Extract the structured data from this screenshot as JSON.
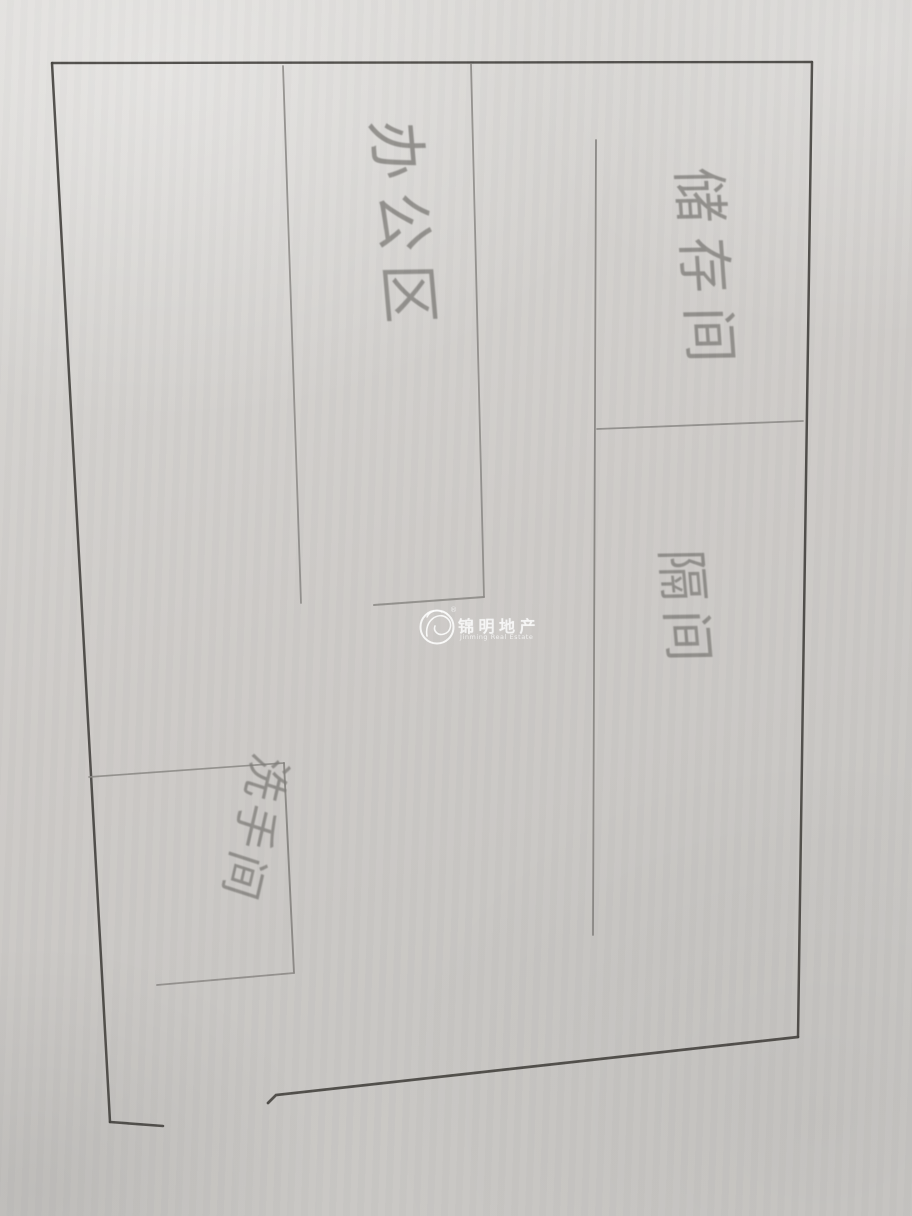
{
  "document_type": "hand-drawn floor plan sketch (pencil on paper photo)",
  "rooms": [
    {
      "id": "office-area",
      "label": "办公区"
    },
    {
      "id": "storage-room",
      "label": "储存间"
    },
    {
      "id": "partition-room",
      "label": "隔间"
    },
    {
      "id": "washroom",
      "label": "洗手间"
    }
  ],
  "watermark": {
    "brand": "锦明地产",
    "brand_en": "Jinming Real Estate",
    "registered_mark": "®"
  },
  "palette": {
    "paper": "#cdcac7",
    "outer_wall_ink": "#45433f",
    "interior_pencil": "#8b8985",
    "handwriting": "#7f7d79",
    "watermark_color": "#ffffff"
  }
}
